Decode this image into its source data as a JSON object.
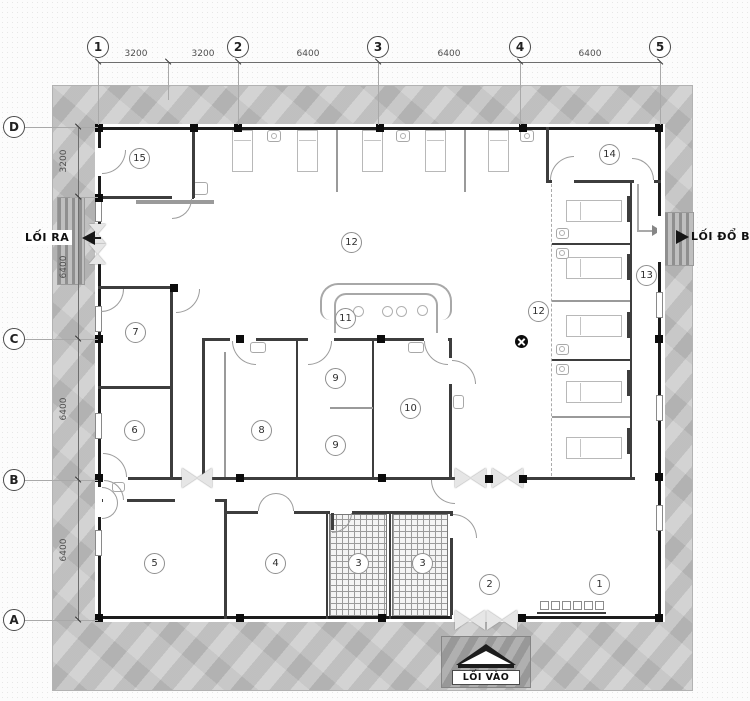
{
  "drawing": {
    "type": "architectural-floor-plan",
    "grid": {
      "columns": [
        {
          "label": "1",
          "x": 98
        },
        {
          "label": "2",
          "x": 238
        },
        {
          "label": "3",
          "x": 378
        },
        {
          "label": "4",
          "x": 520
        },
        {
          "label": "5",
          "x": 660
        }
      ],
      "top_dimensions": [
        {
          "text": "3200",
          "cx": 136
        },
        {
          "text": "3200",
          "cx": 203
        },
        {
          "text": "6400",
          "cx": 308
        },
        {
          "text": "6400",
          "cx": 449
        },
        {
          "text": "6400",
          "cx": 590
        }
      ],
      "rows": [
        {
          "label": "D",
          "y": 127
        },
        {
          "label": "C",
          "y": 339
        },
        {
          "label": "B",
          "y": 480
        },
        {
          "label": "A",
          "y": 620
        }
      ],
      "left_dimensions": [
        {
          "text": "3200",
          "cy": 161
        },
        {
          "text": "6400",
          "cy": 267
        },
        {
          "text": "6400",
          "cy": 409
        },
        {
          "text": "6400",
          "cy": 550
        }
      ]
    },
    "rooms": [
      {
        "number": "1",
        "x": 599,
        "y": 584
      },
      {
        "number": "2",
        "x": 489,
        "y": 584
      },
      {
        "number": "3",
        "x": 358,
        "y": 563
      },
      {
        "number": "3",
        "x": 422,
        "y": 563
      },
      {
        "number": "4",
        "x": 275,
        "y": 563
      },
      {
        "number": "5",
        "x": 154,
        "y": 563
      },
      {
        "number": "6",
        "x": 134,
        "y": 430
      },
      {
        "number": "7",
        "x": 135,
        "y": 332
      },
      {
        "number": "8",
        "x": 261,
        "y": 430
      },
      {
        "number": "9",
        "x": 335,
        "y": 378
      },
      {
        "number": "9",
        "x": 335,
        "y": 445
      },
      {
        "number": "10",
        "x": 410,
        "y": 408
      },
      {
        "number": "11",
        "x": 345,
        "y": 318
      },
      {
        "number": "12",
        "x": 351,
        "y": 242
      },
      {
        "number": "12",
        "x": 538,
        "y": 311
      },
      {
        "number": "13",
        "x": 646,
        "y": 275
      },
      {
        "number": "14",
        "x": 609,
        "y": 154
      },
      {
        "number": "15",
        "x": 139,
        "y": 158
      }
    ],
    "annotations": {
      "exit_left": "LỐI RA",
      "exit_right": "LỐI ĐỔ BẨN",
      "entrance": "LỐI VÀO"
    },
    "colors": {
      "site_band": "#c5c5c5",
      "wall": "#1c1c1c",
      "hatch_line": "#9b9b9b",
      "stamp_bg": "#a2a2a2"
    }
  }
}
